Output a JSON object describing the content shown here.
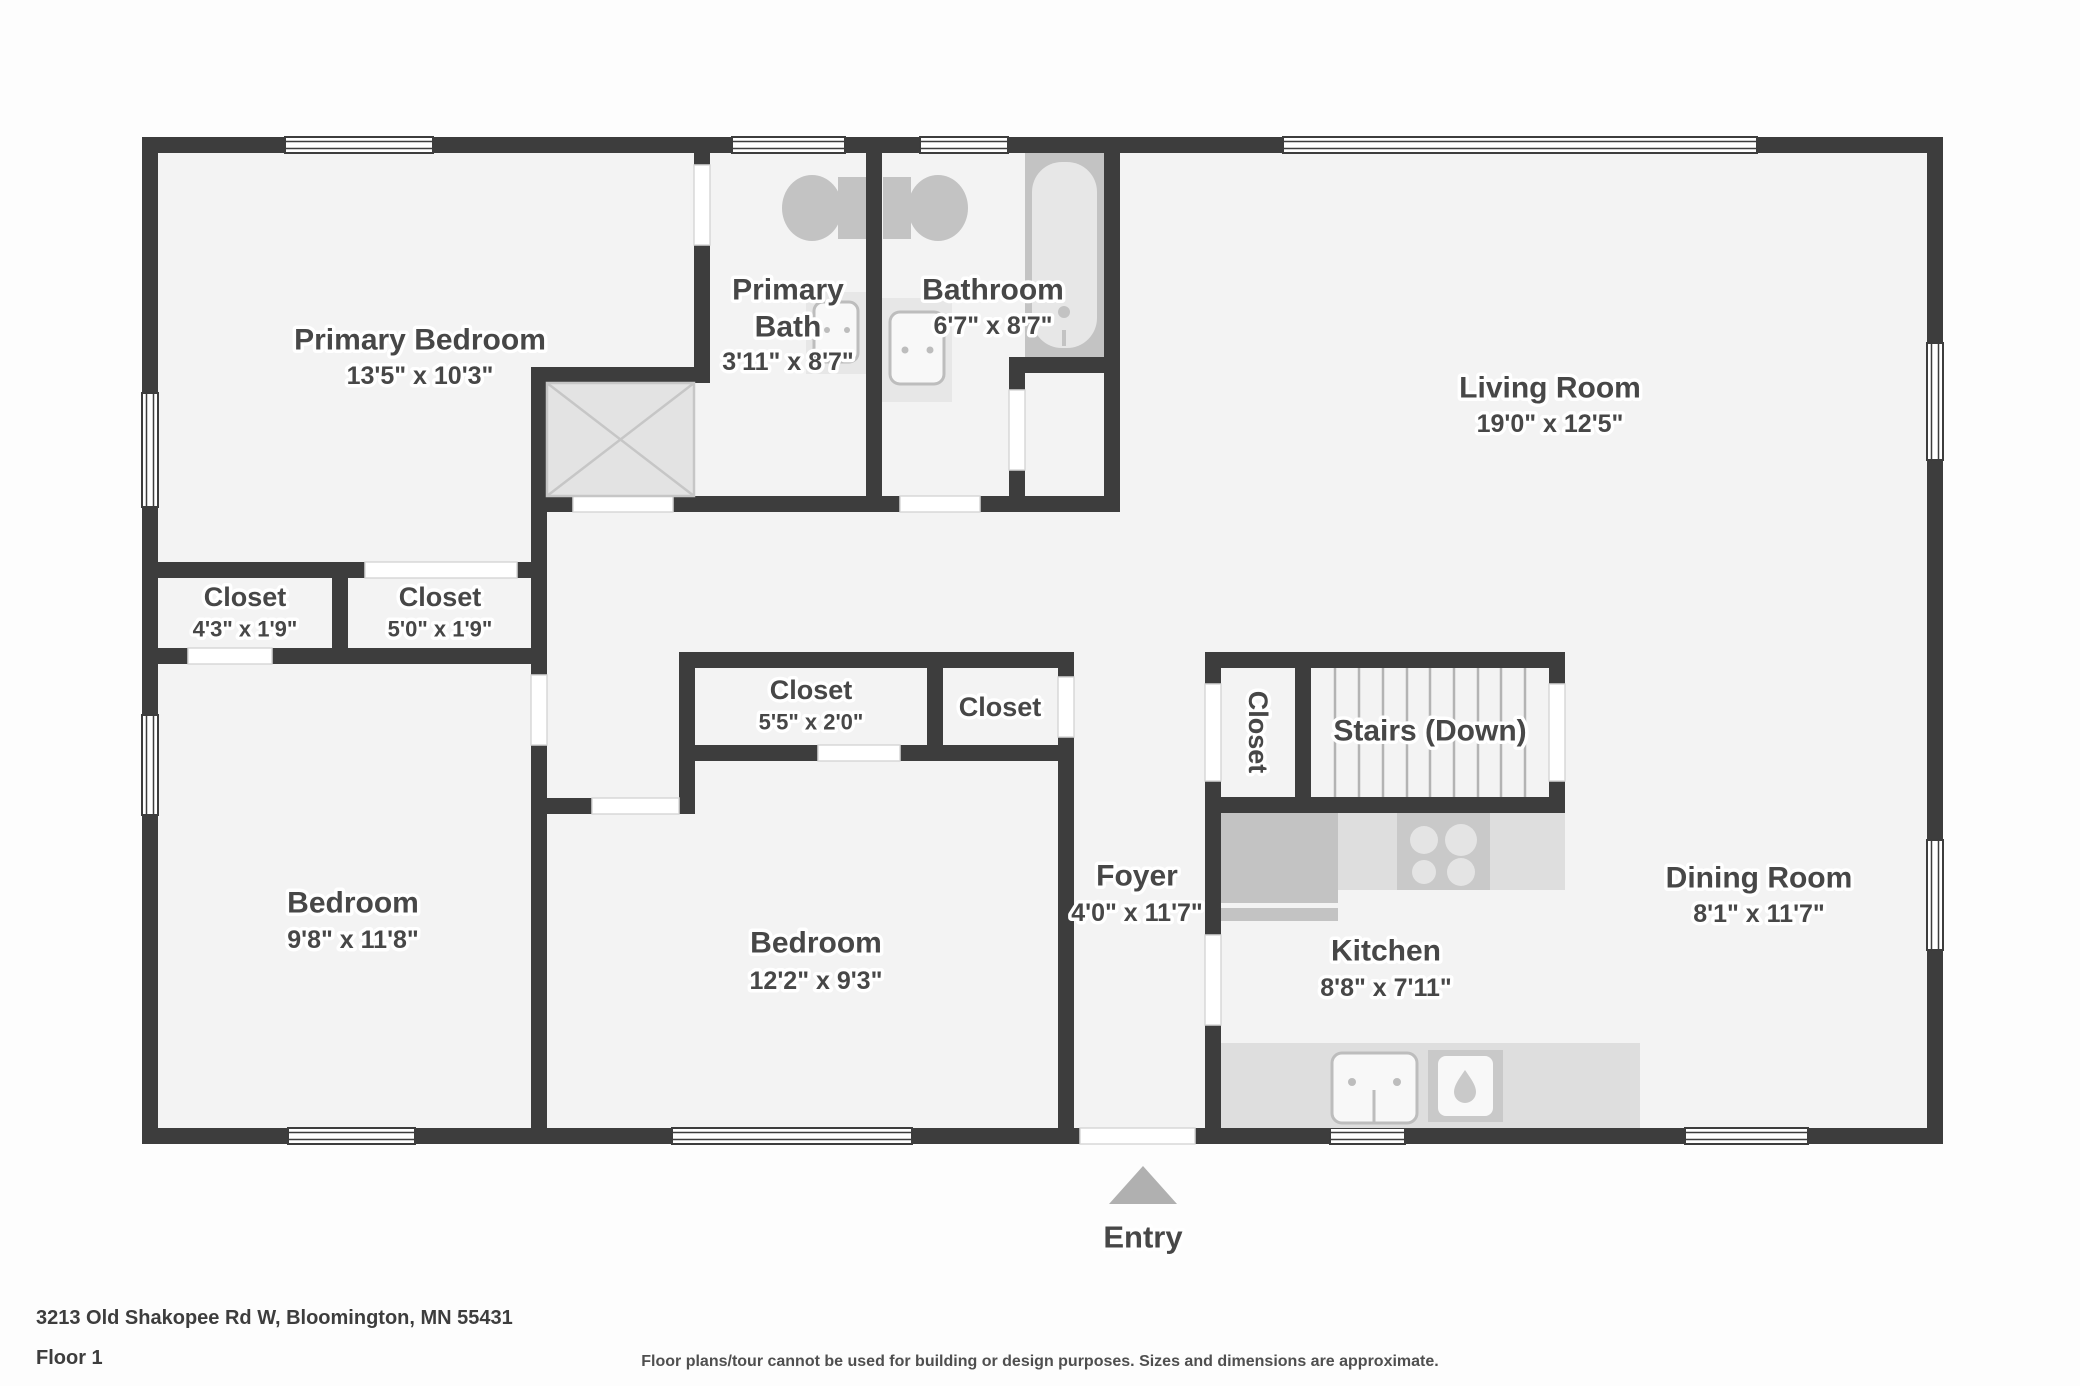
{
  "rooms": {
    "primary_bedroom": {
      "name": "Primary Bedroom",
      "dims": "13'5\" x 10'3\""
    },
    "primary_bath": {
      "name_line1": "Primary",
      "name_line2": "Bath",
      "dims": "3'11\" x 8'7\""
    },
    "bathroom": {
      "name": "Bathroom",
      "dims": "6'7\" x 8'7\""
    },
    "living_room": {
      "name": "Living Room",
      "dims": "19'0\" x 12'5\""
    },
    "closet_1": {
      "name": "Closet",
      "dims": "4'3\" x 1'9\""
    },
    "closet_2": {
      "name": "Closet",
      "dims": "5'0\" x 1'9\""
    },
    "closet_3": {
      "name": "Closet",
      "dims": "5'5\" x 2'0\""
    },
    "closet_4": {
      "name": "Closet"
    },
    "closet_stairs": {
      "name": "Closet"
    },
    "stairs": {
      "name": "Stairs (Down)"
    },
    "bedroom_1": {
      "name": "Bedroom",
      "dims": "9'8\" x 11'8\""
    },
    "bedroom_2": {
      "name": "Bedroom",
      "dims": "12'2\" x 9'3\""
    },
    "foyer": {
      "name": "Foyer",
      "dims": "4'0\" x 11'7\""
    },
    "kitchen": {
      "name": "Kitchen",
      "dims": "8'8\" x 7'11\""
    },
    "dining_room": {
      "name": "Dining Room",
      "dims": "8'1\" x 11'7\""
    }
  },
  "entry": {
    "label": "Entry"
  },
  "footer": {
    "address": "3213 Old Shakopee Rd W, Bloomington, MN 55431",
    "floor": "Floor 1",
    "disclaimer": "Floor plans/tour cannot be used for building or design purposes. Sizes and dimensions are approximate."
  },
  "colors": {
    "wall": "#3d3d3d",
    "floor": "#f3f3f3",
    "fixture": "#c3c3c3",
    "fixture_light": "#e7e7e7",
    "counter": "#dedede",
    "label": "#474747",
    "entry_arrow": "#b0b0b0"
  }
}
